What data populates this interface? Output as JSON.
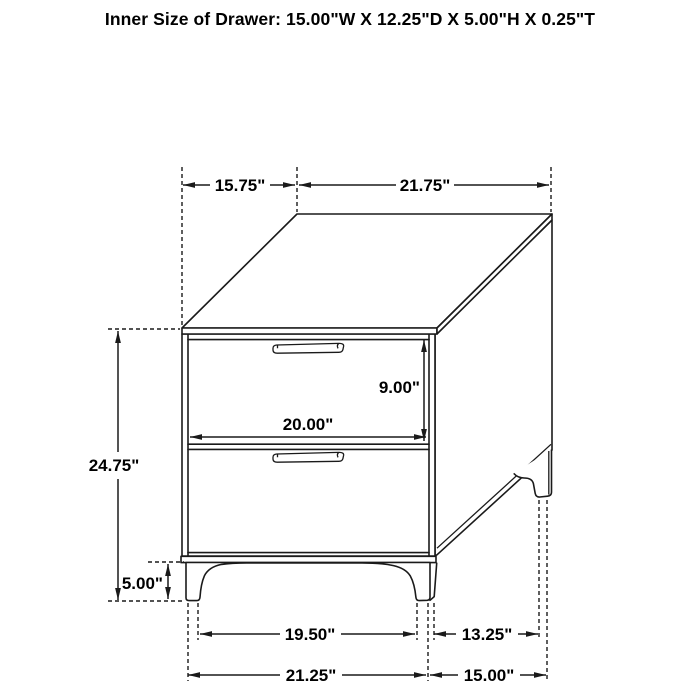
{
  "title": "Inner Size of Drawer: 15.00\"W X 12.25\"D X 5.00\"H X 0.25\"T",
  "dims": {
    "top_depth": "15.75\"",
    "top_width": "21.75\"",
    "drawer_opening_height": "9.00\"",
    "drawer_opening_width": "20.00\"",
    "overall_height": "24.75\"",
    "leg_height": "5.00\"",
    "front_legs_inner_span": "19.50\"",
    "side_legs_inner_span": "13.25\"",
    "front_legs_outer_span": "21.25\"",
    "side_legs_outer_span": "15.00\""
  },
  "colors": {
    "line": "#1a1a1a",
    "background": "#ffffff",
    "text": "#000000"
  }
}
